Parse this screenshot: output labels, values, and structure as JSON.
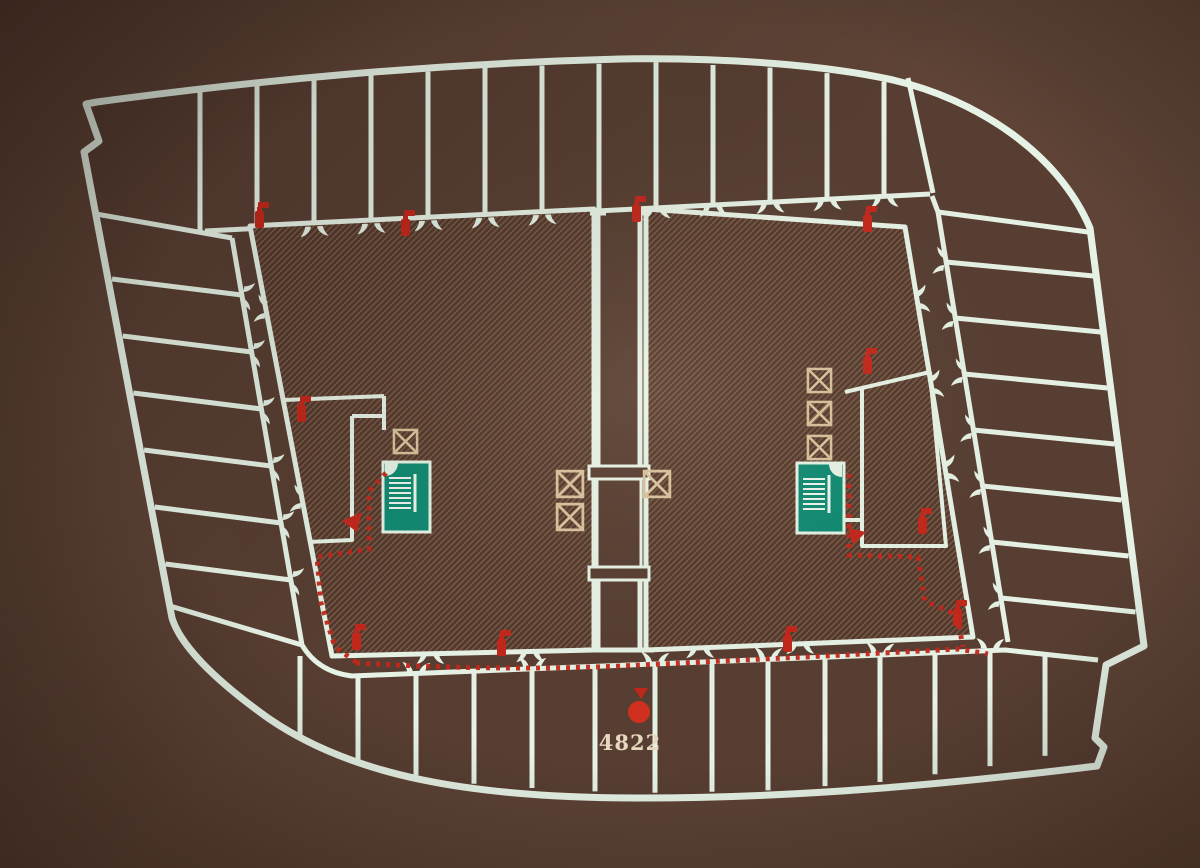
{
  "marker": {
    "label": "4822"
  },
  "colors": {
    "background": "#60structure4538",
    "floor": "#583e32",
    "line": "#e7f3e6",
    "hatch_base": "#52392e",
    "hatch_line": "#7c5a44",
    "route_red": "#c3271b",
    "marker_red": "#d2301f",
    "stair_green": "#0f8a72",
    "elevator_tan": "#d9c29c",
    "label_cream": "#e8d8bf"
  },
  "icons": {
    "fire_extinguisher": "fire-extinguisher-icon",
    "stairs": "stairs-icon",
    "elevator": "elevator-icon",
    "door_swing": "door-swing-icon",
    "escape_route": "escape-route-dotted-line",
    "you_are_here": "you-are-here-dot",
    "direction_arrow": "route-direction-arrow",
    "column_flare": "column-flare-mark"
  }
}
